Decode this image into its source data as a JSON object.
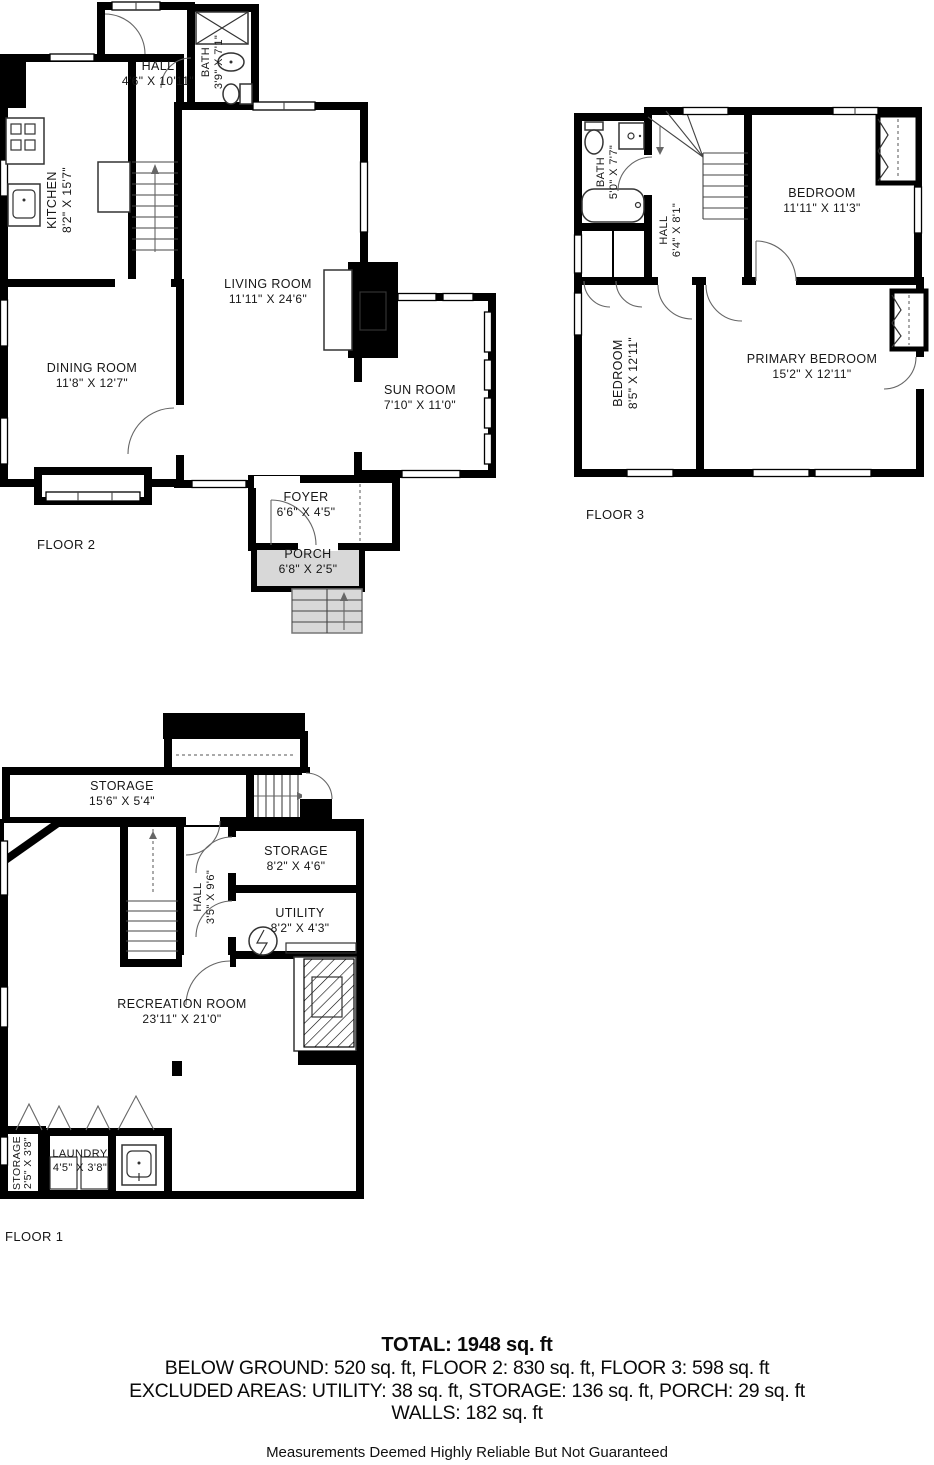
{
  "floor2": {
    "label": "FLOOR 2",
    "rooms": {
      "kitchen": {
        "name": "KITCHEN",
        "dims": "8'2\" X 15'7\""
      },
      "hall": {
        "name": "HALL",
        "dims": "4'6\" X 10'11\""
      },
      "bath": {
        "name": "BATH",
        "dims": "3'9\" X 7'1\""
      },
      "living": {
        "name": "LIVING ROOM",
        "dims": "11'11\" X 24'6\""
      },
      "dining": {
        "name": "DINING ROOM",
        "dims": "11'8\" X 12'7\""
      },
      "sunroom": {
        "name": "SUN ROOM",
        "dims": "7'10\" X 11'0\""
      },
      "foyer": {
        "name": "FOYER",
        "dims": "6'6\" X 4'5\""
      },
      "porch": {
        "name": "PORCH",
        "dims": "6'8\" X 2'5\""
      }
    }
  },
  "floor3": {
    "label": "FLOOR 3",
    "rooms": {
      "bath": {
        "name": "BATH",
        "dims": "5'0\" X 7'7\""
      },
      "hall": {
        "name": "HALL",
        "dims": "6'4\" X 8'1\""
      },
      "bedroom_top": {
        "name": "BEDROOM",
        "dims": "11'11\" X 11'3\""
      },
      "bedroom_left": {
        "name": "BEDROOM",
        "dims": "8'5\" X 12'11\""
      },
      "primary": {
        "name": "PRIMARY BEDROOM",
        "dims": "15'2\" X 12'11\""
      }
    }
  },
  "floor1": {
    "label": "FLOOR 1",
    "rooms": {
      "storage_top": {
        "name": "STORAGE",
        "dims": "15'6\" X 5'4\""
      },
      "hall": {
        "name": "HALL",
        "dims": "3'5\" X 9'6\""
      },
      "storage_mid": {
        "name": "STORAGE",
        "dims": "8'2\" X 4'6\""
      },
      "utility": {
        "name": "UTILITY",
        "dims": "8'2\" X 4'3\""
      },
      "recreation": {
        "name": "RECREATION ROOM",
        "dims": "23'11\" X 21'0\""
      },
      "storage_small": {
        "name": "STORAGE",
        "dims": "2'5\" X 3'8\""
      },
      "laundry": {
        "name": "LAUNDRY",
        "dims": "4'5\" X 3'8\""
      }
    }
  },
  "summary": {
    "total": "TOTAL: 1948 sq. ft",
    "floors_line": "BELOW GROUND: 520 sq. ft, FLOOR 2: 830 sq. ft, FLOOR 3: 598 sq. ft",
    "excluded_line": "EXCLUDED AREAS: UTILITY: 38 sq. ft, STORAGE: 136 sq. ft, PORCH: 29 sq. ft",
    "walls_line": "WALLS: 182 sq. ft",
    "disclaimer": "Measurements Deemed Highly Reliable But Not Guaranteed"
  },
  "colors": {
    "wall": "#000000",
    "bath_fill": "#d9e8f1",
    "porch_fill": "#d8d8d8"
  }
}
